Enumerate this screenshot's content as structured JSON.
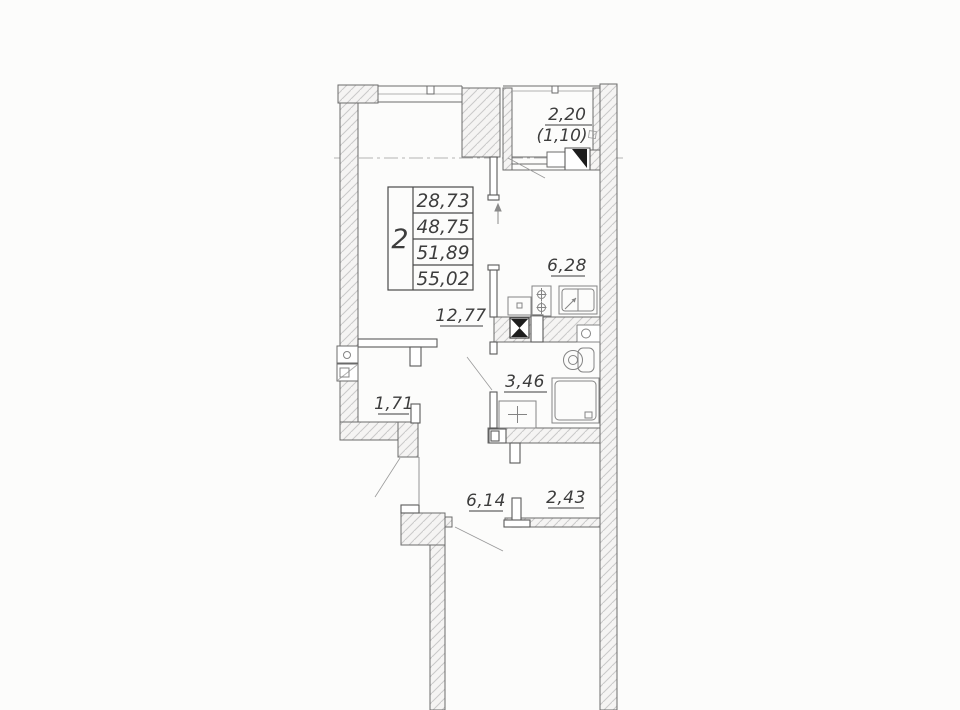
{
  "plan": {
    "table": {
      "rooms_count": "2",
      "areas": [
        "28,73",
        "48,75",
        "51,89",
        "55,02"
      ]
    },
    "rooms": {
      "balcony": {
        "area": "2,20",
        "area_reduced": "(1,10)"
      },
      "kitchen": {
        "area": "6,28"
      },
      "living": {
        "area": "12,77"
      },
      "bathroom": {
        "area": "3,46"
      },
      "closet": {
        "area": "1,71"
      },
      "hallway": {
        "area": "6,14"
      },
      "wardrobe": {
        "area": "2,43"
      }
    },
    "colors": {
      "background": "#fcfcfb",
      "wall_line": "#575757",
      "hatch": "#c9c9c9",
      "fixture_line": "#848484",
      "text": "#3d3d3d",
      "axis_line": "#b3b3b3",
      "solid_fill": "#1d1d1d"
    }
  }
}
